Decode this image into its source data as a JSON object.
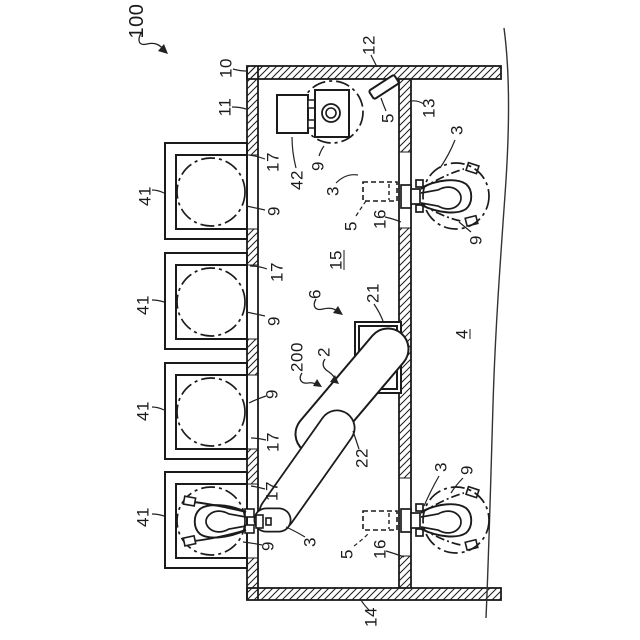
{
  "figure": {
    "title": "Robot work cell patent drawing",
    "background_color": "#ffffff",
    "line_color": "#1b1b1b",
    "labels": [
      {
        "text": "100",
        "x": 137,
        "y": 21,
        "size": 20
      },
      {
        "text": "10",
        "x": 226,
        "y": 68
      },
      {
        "text": "11",
        "x": 225,
        "y": 107
      },
      {
        "text": "12",
        "x": 369,
        "y": 45
      },
      {
        "text": "13",
        "x": 429,
        "y": 108
      },
      {
        "text": "5",
        "x": 388,
        "y": 118
      },
      {
        "text": "42",
        "x": 297,
        "y": 180
      },
      {
        "text": "9",
        "x": 318,
        "y": 166
      },
      {
        "text": "3",
        "x": 333,
        "y": 191
      },
      {
        "text": "5",
        "x": 351,
        "y": 226
      },
      {
        "text": "16",
        "x": 380,
        "y": 219
      },
      {
        "text": "3",
        "x": 457,
        "y": 130
      },
      {
        "text": "9",
        "x": 476,
        "y": 240
      },
      {
        "text": "15",
        "x": 336,
        "y": 260,
        "underline": true
      },
      {
        "text": "6",
        "x": 315,
        "y": 294
      },
      {
        "text": "21",
        "x": 373,
        "y": 293
      },
      {
        "text": "4",
        "x": 462,
        "y": 334,
        "underline": true
      },
      {
        "text": "200",
        "x": 297,
        "y": 357
      },
      {
        "text": "2",
        "x": 324,
        "y": 352
      },
      {
        "text": "22",
        "x": 362,
        "y": 458
      },
      {
        "text": "17",
        "x": 273,
        "y": 162
      },
      {
        "text": "9",
        "x": 274,
        "y": 211
      },
      {
        "text": "17",
        "x": 277,
        "y": 272
      },
      {
        "text": "9",
        "x": 274,
        "y": 321
      },
      {
        "text": "9",
        "x": 272,
        "y": 394
      },
      {
        "text": "17",
        "x": 273,
        "y": 442
      },
      {
        "text": "17",
        "x": 272,
        "y": 491
      },
      {
        "text": "9",
        "x": 268,
        "y": 546
      },
      {
        "text": "3",
        "x": 310,
        "y": 542
      },
      {
        "text": "5",
        "x": 347,
        "y": 554
      },
      {
        "text": "16",
        "x": 380,
        "y": 549
      },
      {
        "text": "3",
        "x": 441,
        "y": 467
      },
      {
        "text": "9",
        "x": 467,
        "y": 470
      },
      {
        "text": "14",
        "x": 371,
        "y": 617
      },
      {
        "text": "41",
        "x": 145,
        "y": 196
      },
      {
        "text": "41",
        "x": 143,
        "y": 305
      },
      {
        "text": "41",
        "x": 143,
        "y": 411
      },
      {
        "text": "41",
        "x": 143,
        "y": 517
      }
    ]
  }
}
